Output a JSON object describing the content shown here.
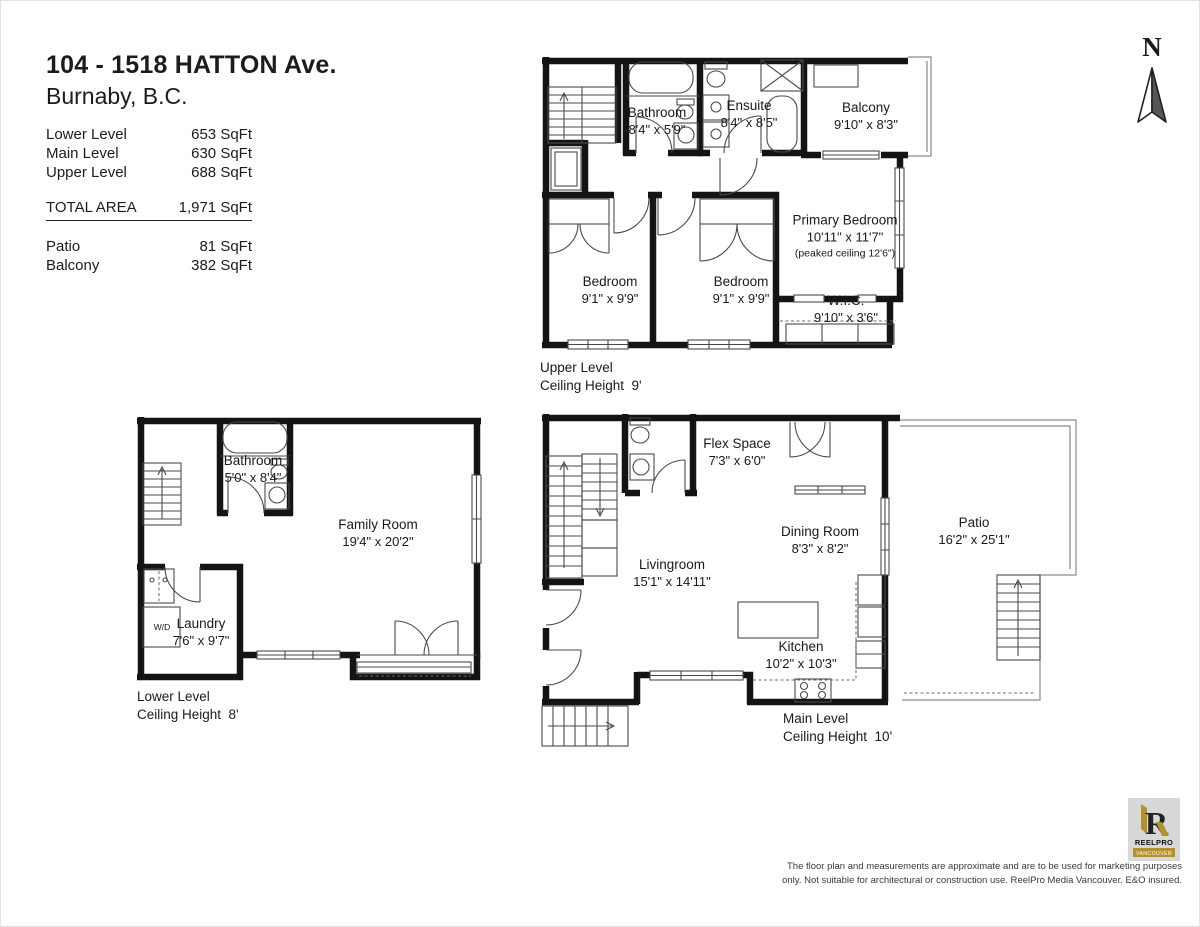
{
  "header": {
    "address_line1": "104 - 1518 HATTON Ave.",
    "address_line2": "Burnaby, B.C.",
    "area_rows": [
      {
        "label": "Lower Level",
        "value": "653 SqFt"
      },
      {
        "label": "Main Level",
        "value": "630 SqFt"
      },
      {
        "label": "Upper Level",
        "value": "688 SqFt"
      }
    ],
    "total_row": {
      "label": "TOTAL AREA",
      "value": "1,971 SqFt"
    },
    "extra_rows": [
      {
        "label": "Patio",
        "value": "81 SqFt"
      },
      {
        "label": "Balcony",
        "value": "382 SqFt"
      }
    ]
  },
  "compass": {
    "label": "N"
  },
  "floors": {
    "upper": {
      "level_name": "Upper Level",
      "ceiling": "Ceiling Height  9'",
      "rooms": {
        "bathroom": {
          "name": "Bathroom",
          "dims": "8'4\" x 5'9\""
        },
        "ensuite": {
          "name": "Ensuite",
          "dims": "8'4\" x 8'5\""
        },
        "balcony": {
          "name": "Balcony",
          "dims": "9'10\" x 8'3\""
        },
        "primary": {
          "name": "Primary Bedroom",
          "dims": "10'11\" x 11'7\"",
          "note": "(peaked ceiling 12'6\")"
        },
        "bedroom1": {
          "name": "Bedroom",
          "dims": "9'1\" x 9'9\""
        },
        "bedroom2": {
          "name": "Bedroom",
          "dims": "9'1\" x 9'9\""
        },
        "wic": {
          "name": "W.I.C.",
          "dims": "9'10\" x 3'6\""
        }
      }
    },
    "lower": {
      "level_name": "Lower Level",
      "ceiling": "Ceiling Height  8'",
      "wd_label": "W/D",
      "rooms": {
        "bathroom": {
          "name": "Bathroom",
          "dims": "5'0\" x 8'4\""
        },
        "family": {
          "name": "Family Room",
          "dims": "19'4\" x 20'2\""
        },
        "laundry": {
          "name": "Laundry",
          "dims": "7'6\" x 9'7\""
        }
      }
    },
    "main": {
      "level_name": "Main Level",
      "ceiling": "Ceiling Height  10'",
      "rooms": {
        "flex": {
          "name": "Flex Space",
          "dims": "7'3\" x 6'0\""
        },
        "dining": {
          "name": "Dining Room",
          "dims": "8'3\" x 8'2\""
        },
        "living": {
          "name": "Livingroom",
          "dims": "15'1\" x 14'11\""
        },
        "kitchen": {
          "name": "Kitchen",
          "dims": "10'2\" x 10'3\""
        },
        "patio": {
          "name": "Patio",
          "dims": "16'2\" x 25'1\""
        }
      }
    }
  },
  "branding": {
    "logo_title": "REELPRO",
    "logo_subtitle": "VANCOUVER",
    "accent_gold": "#b3922e",
    "logo_bg": "#d8d8d8"
  },
  "disclaimer": {
    "line1": "The floor plan and measurements are approximate and are to be used for marketing purposes",
    "line2": "only. Not suitable for architectural or construction use. ReelPro Media Vancouver. E&O insured."
  }
}
